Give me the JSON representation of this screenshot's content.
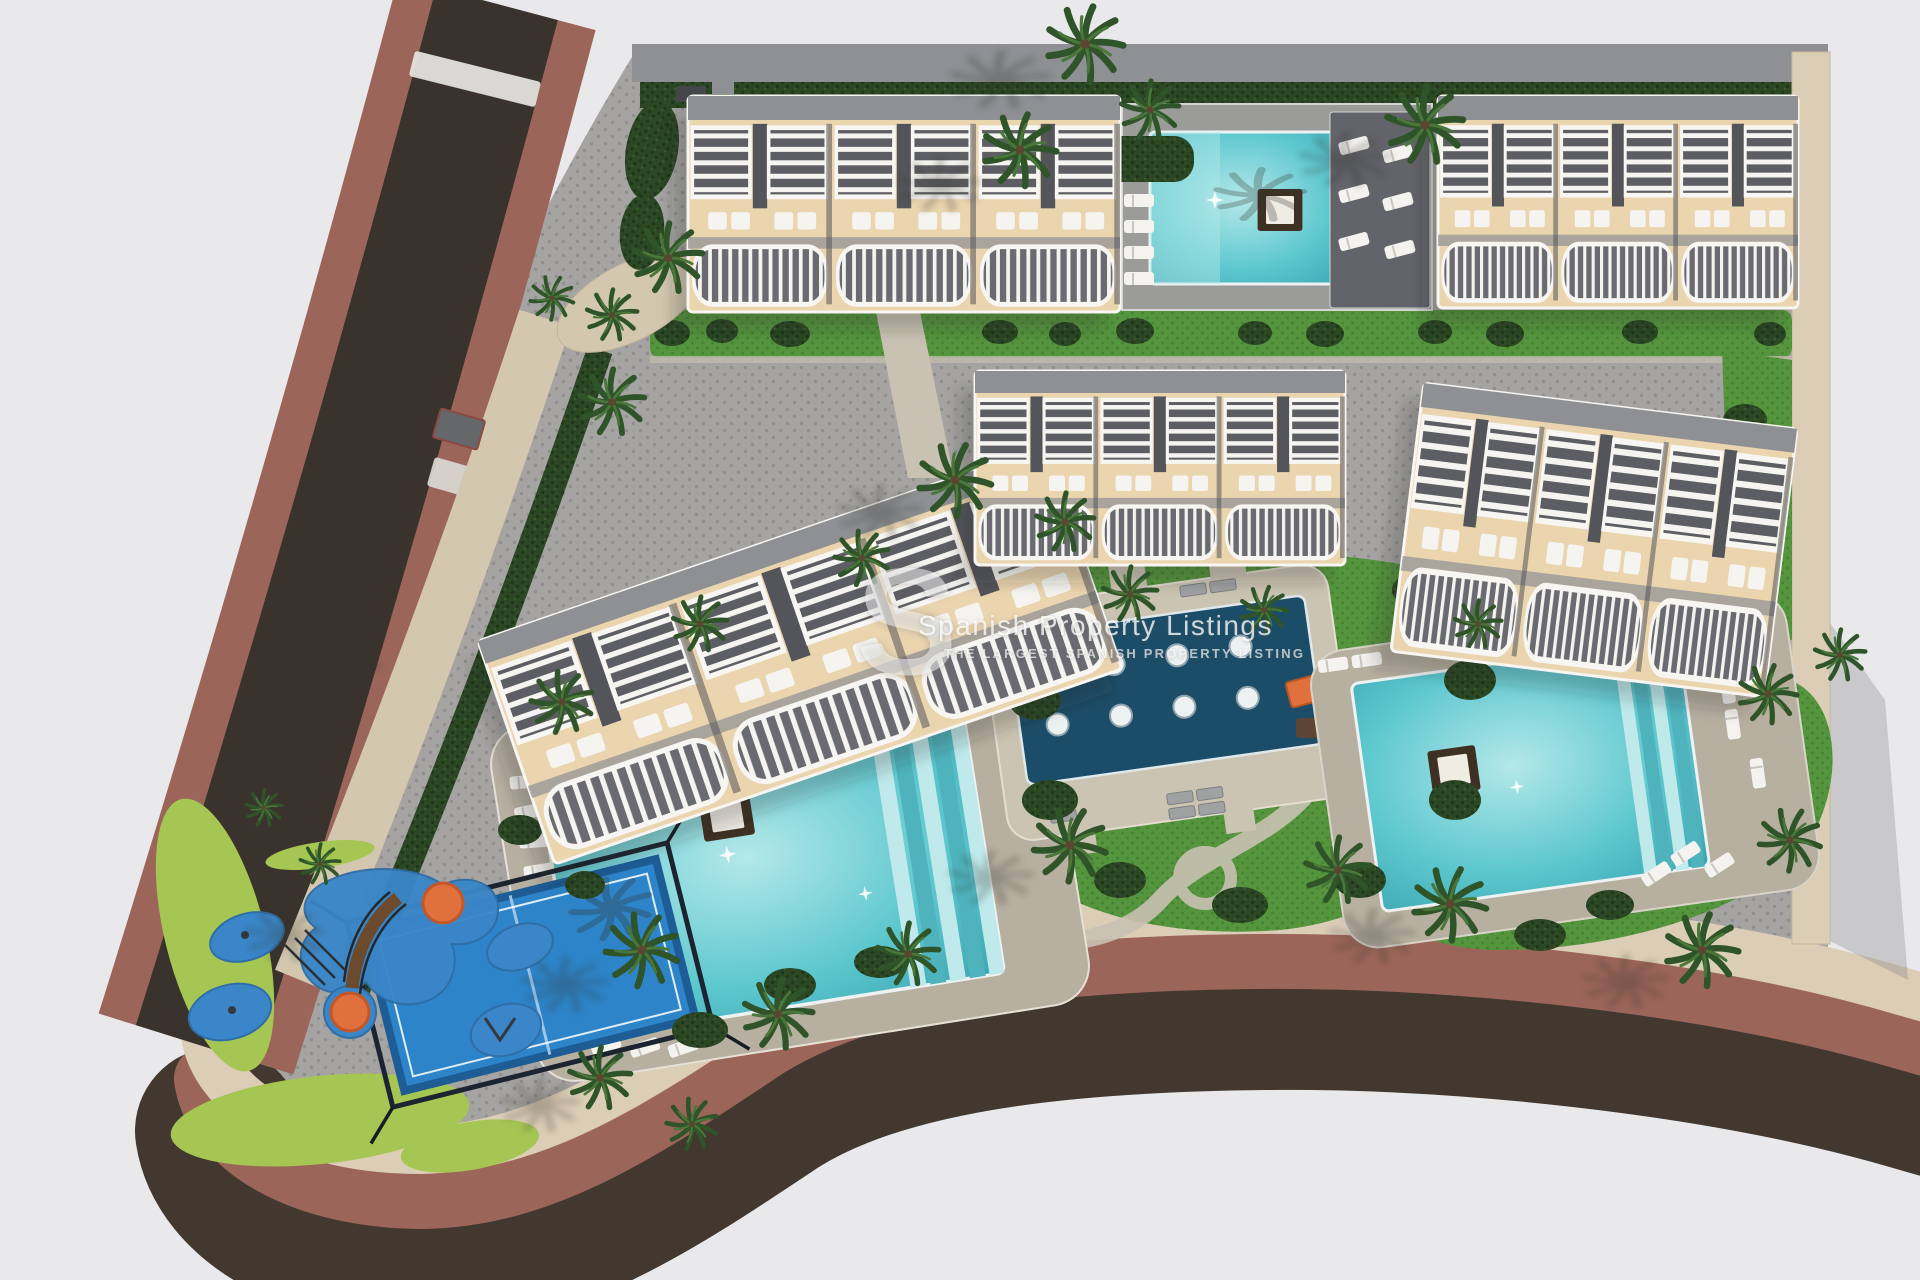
{
  "watermark": {
    "logo": "S",
    "title": "Spanish Property Listings",
    "subtitle": "THE LARGEST SPANISH PROPERTY LISTING"
  },
  "palette": {
    "background": "#e9e9eb",
    "asphalt": "#3a332d",
    "bottom_band": "#42382f",
    "sidewalk": "#9c655a",
    "curb": "#dbcdb6",
    "gravel": "#d3c7af",
    "paving": "#a5a4a2",
    "paving_dot": "#918f8d",
    "deck": "#b7afa0",
    "deck_light": "#ccc4b2",
    "path": "#c9c2b3",
    "roof_slab": "#8f9094",
    "building_base": "#ead5af",
    "building_white": "#f7f6f2",
    "building_dark": "#54555a",
    "pool_light": "#b4e8e9",
    "pool_main": "#5ec8cf",
    "pool_deep": "#3da7b4",
    "splash_pool": "#1c4d68",
    "lawn": "#55953e",
    "lawn_dot": "#46822f",
    "hedge": "#2b4724",
    "hedge_dot": "#1f3719",
    "light_grass": "#a6c653",
    "palm": "#2f5429",
    "palm_light": "#49773a",
    "court_blue": "#2d84c8",
    "court_border": "#1d5c95",
    "play_blue": "#3a86c8",
    "play_orange": "#e0703c",
    "daybed": "#3e3022"
  },
  "scene": {
    "type": "aerial-3d-render",
    "subject": "residential development site plan",
    "buildings": 5,
    "swimming_pools": 3,
    "splash_pools": 1,
    "padel_courts": 1,
    "playgrounds": 2
  }
}
